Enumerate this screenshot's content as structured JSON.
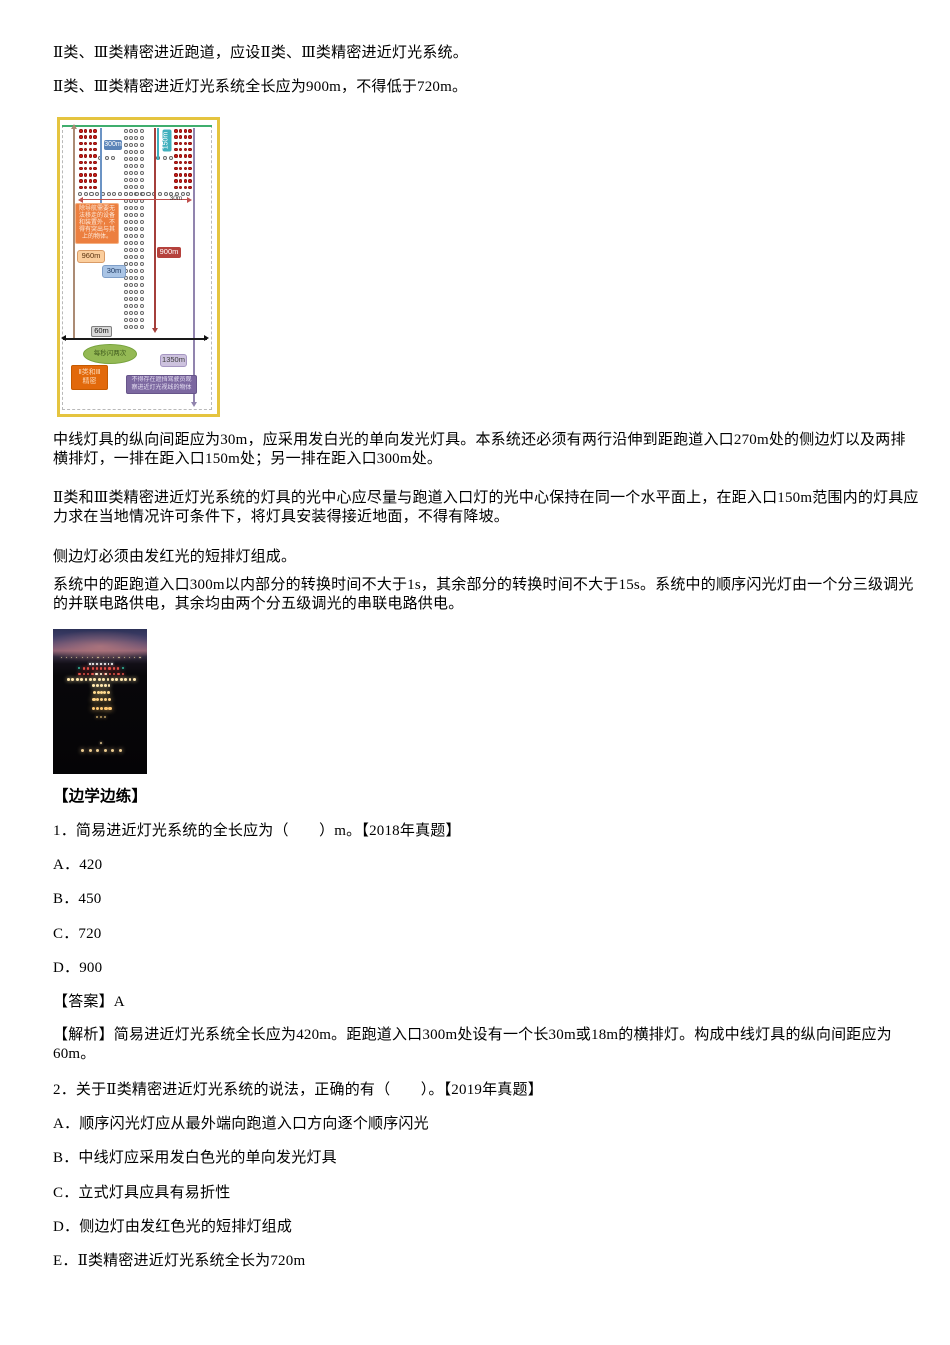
{
  "content": {
    "p1": "Ⅱ类、Ⅲ类精密进近跑道，应设Ⅱ类、Ⅲ类精密进近灯光系统。",
    "p2": "Ⅱ类、Ⅲ类精密进近灯光系统全长应为900m，不得低于720m。",
    "p3": "中线灯具的纵向间距应为30m，应采用发白光的单向发光灯具。本系统还必须有两行沿伸到距跑道入口270m处的侧边灯以及两排横排灯，一排在距入口150m处；另一排在距入口300m处。",
    "p4": "Ⅱ类和Ⅲ类精密进近灯光系统的灯具的光中心应尽量与跑道入口灯的光中心保持在同一个水平面上，在距入口150m范围内的灯具应力求在当地情况许可条件下，将灯具安装得接近地面，不得有降坡。",
    "p5": "侧边灯必须由发红光的短排灯组成。",
    "p6": "系统中的距跑道入口300m以内部分的转换时间不大于1s，其余部分的转换时间不大于15s。系统中的顺序闪光灯由一个分三级调光的并联电路供电，其余均由两个分五级调光的串联电路供电。"
  },
  "practice": {
    "heading": "【边学边练】",
    "q1": {
      "stem": "1．简易进近灯光系统的全长应为（　　）m。【2018年真题】",
      "options": [
        "A．420",
        "B．450",
        "C．720",
        "D．900"
      ],
      "answer": "【答案】A",
      "analysis": "【解析】简易进近灯光系统全长应为420m。距跑道入口300m处设有一个长30m或18m的横排灯。构成中线灯具的纵向间距应为60m。"
    },
    "q2": {
      "stem": "2．关于Ⅱ类精密进近灯光系统的说法，正确的有（　　）。【2019年真题】",
      "options": [
        "A．顺序闪光灯应从最外端向跑道入口方向逐个顺序闪光",
        "B．中线灯应采用发白色光的单向发光灯具",
        "C．立式灯具应具有易折性",
        "D．侧边灯由发红色光的短排灯组成",
        "E．Ⅱ类精密进近灯光系统全长为720m"
      ]
    }
  },
  "diagram": {
    "border_color": "#e5c43f",
    "grids": [
      {
        "name": "left-side-barrette-lights",
        "x": 19,
        "y": 9,
        "cols": 4,
        "rows": 10,
        "dx": 4.8,
        "dy": 6.3,
        "d": 3.6,
        "fill": "#cf1d17",
        "stroke": "#8f0f0c"
      },
      {
        "name": "right-side-barrette-lights",
        "x": 114,
        "y": 9,
        "cols": 4,
        "rows": 10,
        "dx": 4.8,
        "dy": 6.3,
        "d": 3.6,
        "fill": "#cf1d17",
        "stroke": "#8f0f0c"
      },
      {
        "name": "centerline-lights",
        "x": 64,
        "y": 9,
        "cols": 4,
        "rows": 29,
        "dx": 5.2,
        "dy": 7.0,
        "d": 4.0,
        "fill": "#ffffff",
        "stroke": "#666666"
      },
      {
        "name": "inner-crossbar-left",
        "x": 38,
        "y": 36,
        "cols": 3,
        "rows": 1,
        "dx": 6.5,
        "dy": 6,
        "d": 4.2,
        "fill": "#ffffff",
        "stroke": "#666666"
      },
      {
        "name": "inner-crossbar-right",
        "x": 96,
        "y": 36,
        "cols": 3,
        "rows": 1,
        "dx": 6.5,
        "dy": 6,
        "d": 4.2,
        "fill": "#ffffff",
        "stroke": "#666666"
      },
      {
        "name": "300m-crossbar-lights",
        "x": 18,
        "y": 72,
        "cols": 20,
        "rows": 1,
        "dx": 5.7,
        "dy": 6,
        "d": 4.2,
        "fill": "#ffffff",
        "stroke": "#666666"
      }
    ],
    "lines": [
      {
        "name": "boundary-dashed-box",
        "x": 2,
        "y": 5,
        "w": 150,
        "h": 285,
        "dash": 1
      },
      {
        "name": "runway-threshold-line",
        "x": 2,
        "y": 5,
        "w": 150,
        "h": 2,
        "c": "#3fae6e"
      },
      {
        "name": "960m-measure-line",
        "x": 13,
        "y": 8,
        "w": 1.5,
        "h": 210,
        "c": "#ab8b74"
      },
      {
        "name": "300m-measure-line",
        "x": 40,
        "y": 8,
        "w": 1.5,
        "h": 105,
        "c": "#6b93c4"
      },
      {
        "name": "150m-measure-line",
        "x": 97,
        "y": 8,
        "w": 1.5,
        "h": 32,
        "c": "#3fb0bd"
      },
      {
        "name": "900m-measure-line",
        "x": 94,
        "y": 8,
        "w": 1.5,
        "h": 202,
        "c": "#a43f3b"
      },
      {
        "name": "1350m-measure-line",
        "x": 133,
        "y": 8,
        "w": 1.5,
        "h": 276,
        "c": "#9184ae"
      },
      {
        "name": "30m-width-arrow",
        "x": 20,
        "y": 79,
        "w": 110,
        "h": 1,
        "c": "#c0504d"
      },
      {
        "name": "60m-width-arrow",
        "x": 3,
        "y": 218,
        "w": 144,
        "h": 1.5,
        "c": "#1a1a1a"
      }
    ],
    "tris": [
      {
        "x": 10.5,
        "y": 4,
        "dir": "up",
        "c": "#ab8b74"
      },
      {
        "x": 92,
        "y": 208,
        "dir": "down",
        "c": "#a43f3b"
      },
      {
        "x": 131,
        "y": 282,
        "dir": "down",
        "c": "#9184ae"
      },
      {
        "x": 1,
        "y": 215,
        "dir": "left",
        "c": "#111111"
      },
      {
        "x": 144,
        "y": 215,
        "dir": "right",
        "c": "#111111"
      },
      {
        "x": 18,
        "y": 76.5,
        "dir": "left",
        "c": "#c0504d"
      },
      {
        "x": 127,
        "y": 76.5,
        "dir": "right",
        "c": "#c0504d"
      }
    ],
    "labels": [
      {
        "t": "300m",
        "x": 44,
        "y": 20,
        "w": 18,
        "h": 10,
        "bg": "#5b84b8",
        "fg": "#ffffff",
        "fs": 7,
        "br": "2px"
      },
      {
        "t": "150m",
        "x": 96,
        "y": 16,
        "w": 22,
        "h": 9,
        "bg": "#41b0bd",
        "fg": "#ffffff",
        "fs": 7,
        "br": "2px",
        "rot": -90
      },
      {
        "t": "30m",
        "x": 106,
        "y": 75,
        "w": 20,
        "h": 8,
        "bg": "none",
        "fg": "#333333",
        "fs": 6.5
      },
      {
        "t": "除导航需要无\n法移走的设备\n和装置外，不\n得有突出与其\n上的物体。",
        "x": 15,
        "y": 83,
        "w": 44,
        "h": 41,
        "bg": "#ec7f3f",
        "fg": "#fde9d9",
        "fs": 6,
        "br": "2px",
        "bd": "#f5b183"
      },
      {
        "t": "960m",
        "x": 17,
        "y": 130,
        "w": 28,
        "h": 13,
        "bg": "#fbce9d",
        "fg": "#5a3310",
        "fs": 7.5,
        "br": "3px",
        "bd": "#d99b66"
      },
      {
        "t": "30m",
        "x": 42,
        "y": 145,
        "w": 24,
        "h": 13,
        "bg": "#a9c4e5",
        "fg": "#1f3a63",
        "fs": 7.5,
        "br": "3px",
        "bd": "#7f9fc9"
      },
      {
        "t": "900m",
        "x": 97,
        "y": 127,
        "w": 24,
        "h": 11,
        "bg": "#b5413c",
        "fg": "#ffffff",
        "fs": 7.5,
        "br": "2px"
      },
      {
        "t": "60m",
        "x": 31,
        "y": 206,
        "w": 21,
        "h": 11,
        "bg": "#d8d8d8",
        "fg": "#111111",
        "fs": 7.5,
        "br": "2px",
        "bd": "#7f7f7f"
      },
      {
        "t": "每秒闪两次",
        "x": 23,
        "y": 224,
        "w": 54,
        "h": 20,
        "bg": "#94b954",
        "fg": "#3f5a1e",
        "fs": 6.5,
        "br": "50%",
        "bd": "#76a23c"
      },
      {
        "t": "1350m",
        "x": 100,
        "y": 234,
        "w": 27,
        "h": 13,
        "bg": "#cdc2de",
        "fg": "#3b3b3b",
        "fs": 7.5,
        "br": "3px",
        "bd": "#a697c2"
      },
      {
        "t": "Ⅱ类和Ⅲ\n精密",
        "x": 11,
        "y": 245,
        "w": 37,
        "h": 25,
        "bg": "#e2690b",
        "fg": "#fcd9b8",
        "fs": 7,
        "br": "2px",
        "bd": "#c55a00"
      },
      {
        "t": "不得存在遮挡驾驶员观\n察进近灯光视线的物体",
        "x": 66,
        "y": 255,
        "w": 71,
        "h": 19,
        "bg": "#7c68a0",
        "fg": "#e6dff2",
        "fs": 6,
        "br": "2px",
        "bd": "#67558a"
      }
    ]
  },
  "photo": {
    "description": "runway-approach-lights-night-photo",
    "light_rows": [
      {
        "y": 19,
        "x1": 8,
        "x2": 92,
        "n": 16,
        "c": "#cdb793",
        "s": 1.2
      },
      {
        "y": 23.5,
        "x1": 38,
        "x2": 62,
        "n": 7,
        "c": "#ffffff",
        "s": 1.8
      },
      {
        "y": 26.5,
        "x1": 27,
        "x2": 73,
        "n": 2,
        "c": "#35b89e",
        "s": 2
      },
      {
        "y": 26.5,
        "x1": 32,
        "x2": 68,
        "n": 9,
        "c": "#e25048",
        "s": 2.2
      },
      {
        "y": 30,
        "x1": 27,
        "x2": 73,
        "n": 11,
        "c": "#e25048",
        "s": 2.4
      },
      {
        "y": 30,
        "x1": 45,
        "x2": 55,
        "n": 3,
        "c": "#fff6dc",
        "s": 2.4
      },
      {
        "y": 34,
        "x1": 15,
        "x2": 85,
        "n": 16,
        "c": "#ffe7ae",
        "s": 2.8
      },
      {
        "y": 38,
        "x1": 42,
        "x2": 58,
        "n": 5,
        "c": "#ffe7ae",
        "s": 2.8
      },
      {
        "y": 42.5,
        "x1": 43,
        "x2": 57,
        "n": 5,
        "c": "#ffd98f",
        "s": 3
      },
      {
        "y": 47.5,
        "x1": 42,
        "x2": 58,
        "n": 5,
        "c": "#ffd285",
        "s": 3.2
      },
      {
        "y": 53.5,
        "x1": 41,
        "x2": 59,
        "n": 5,
        "c": "#ffc873",
        "s": 3.4
      },
      {
        "y": 60,
        "x1": 46,
        "x2": 54,
        "n": 3,
        "c": "#b89a60",
        "s": 2
      },
      {
        "y": 78,
        "x1": 49,
        "x2": 51,
        "n": 1,
        "c": "#c8b080",
        "s": 1.6
      },
      {
        "y": 83,
        "x1": 30,
        "x2": 70,
        "n": 6,
        "c": "#eccb90",
        "s": 3
      }
    ]
  }
}
